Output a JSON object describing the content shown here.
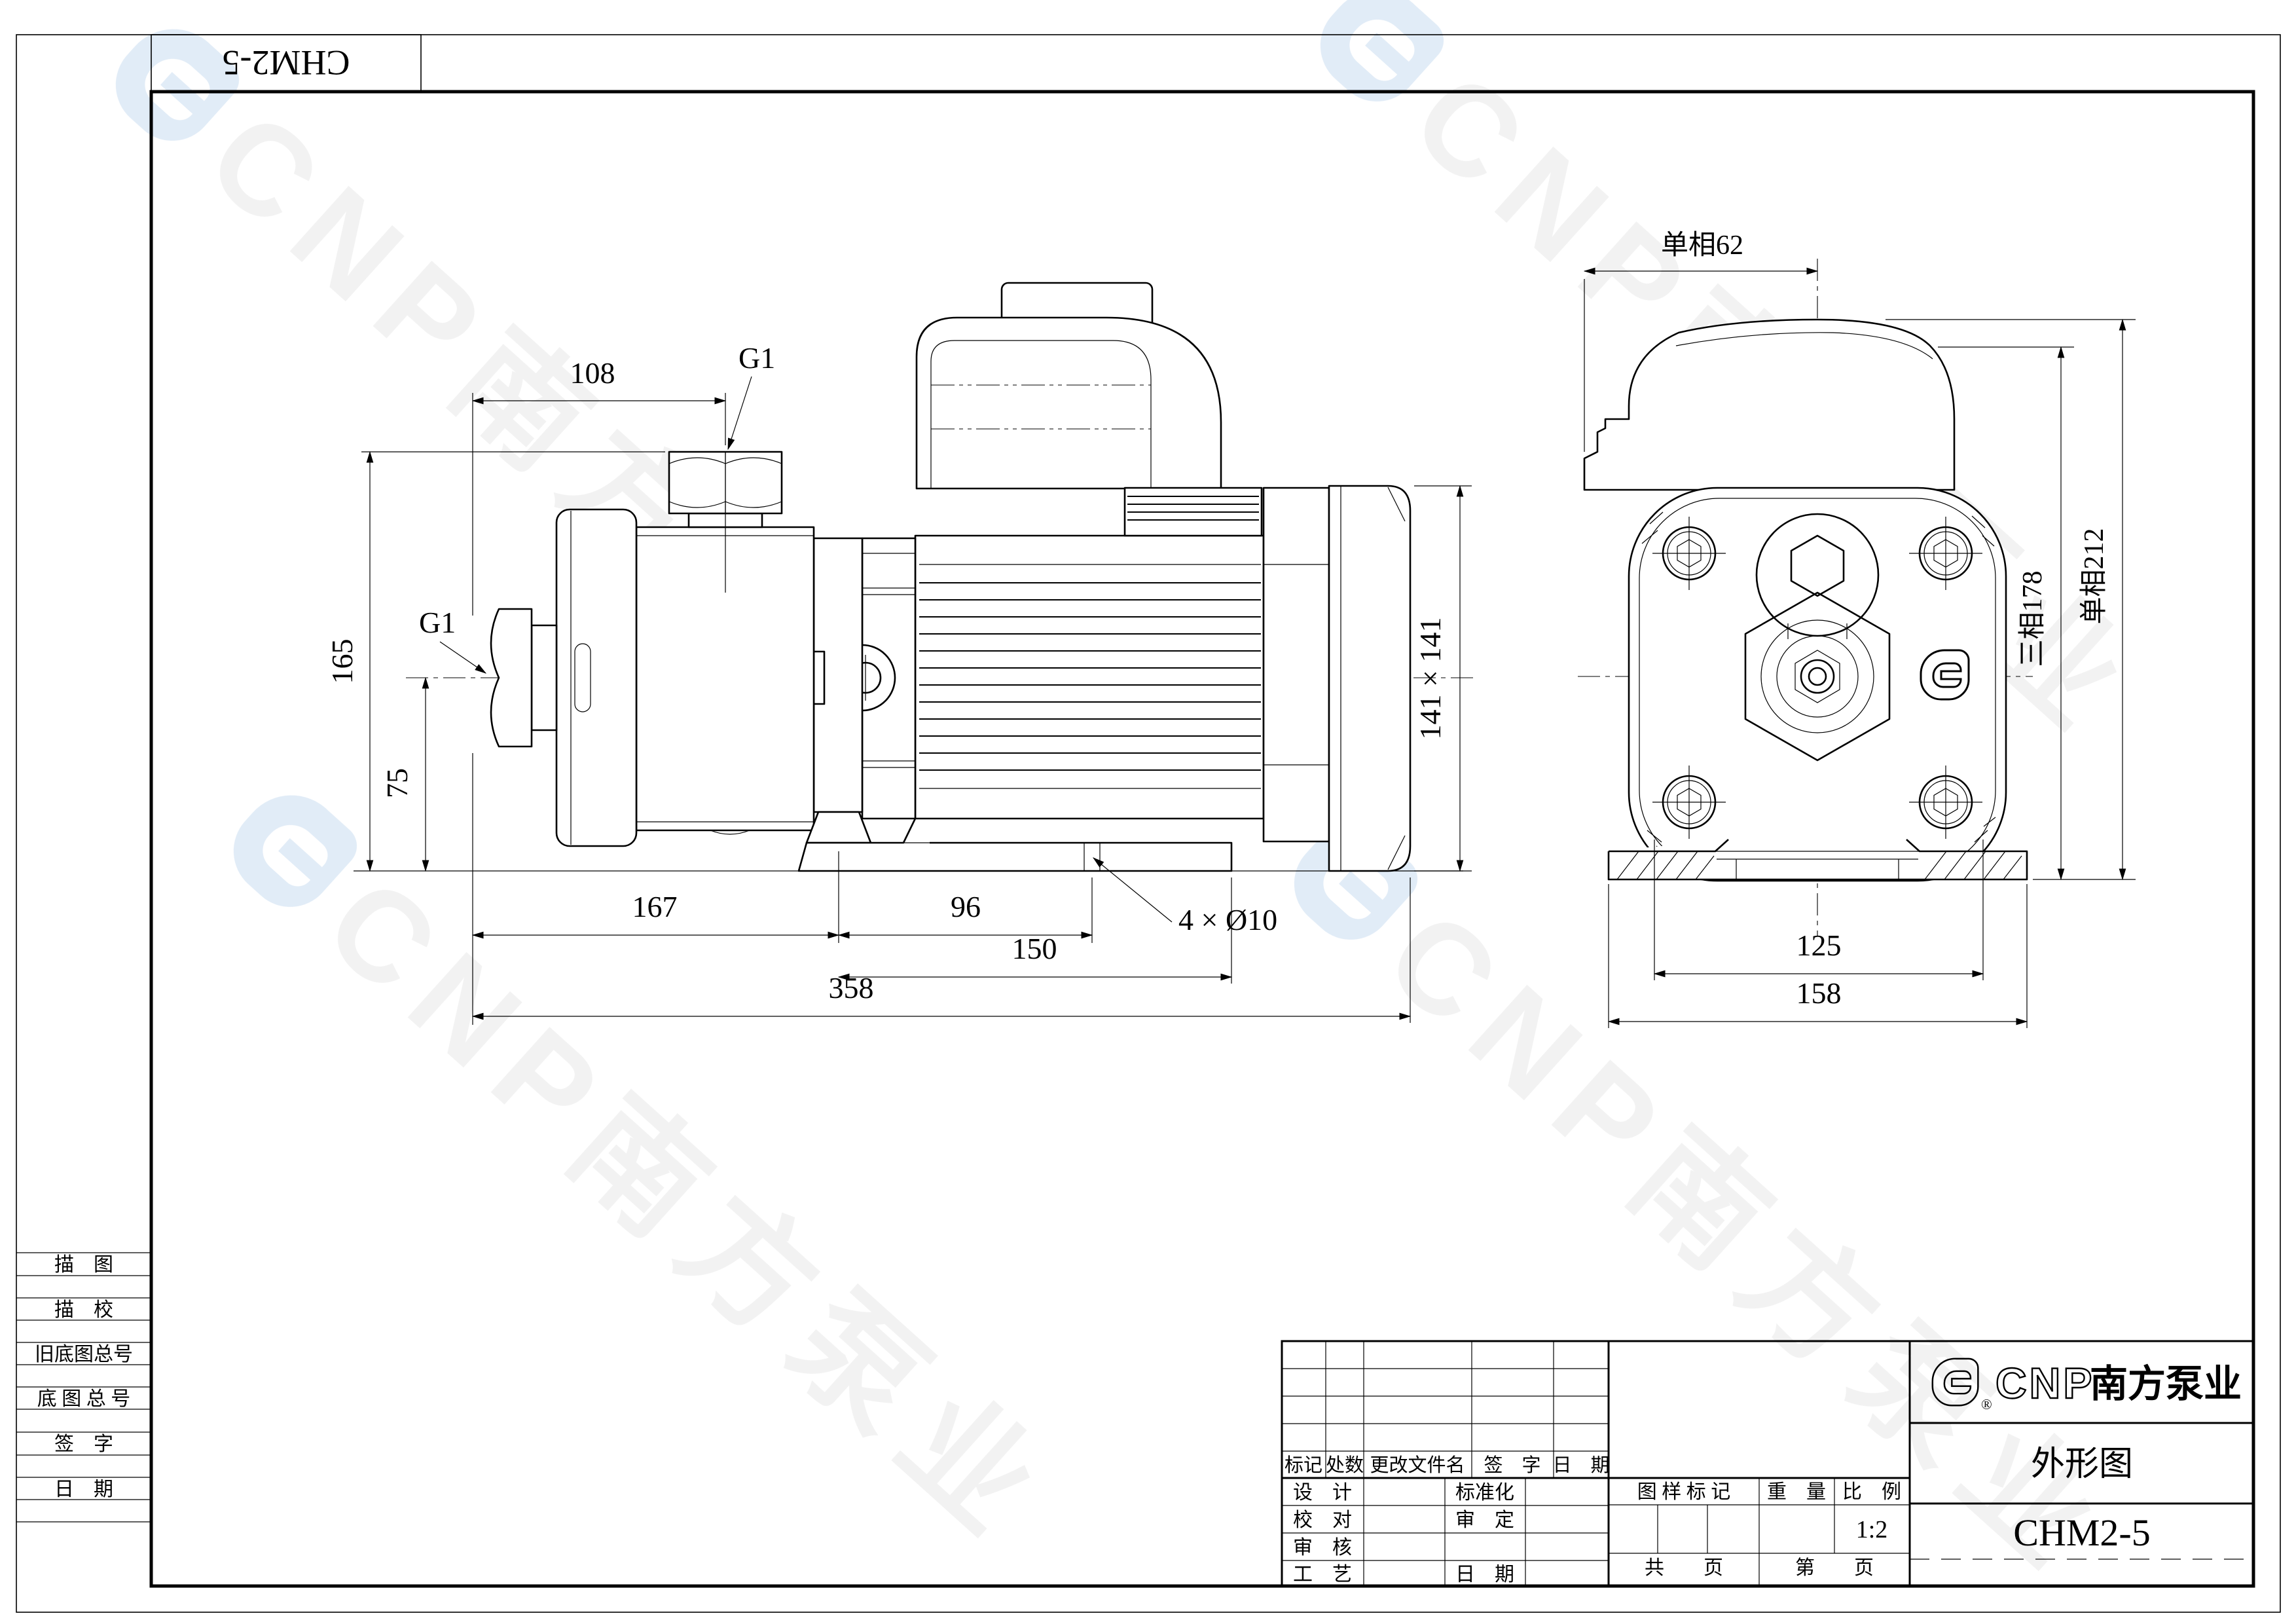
{
  "watermark": {
    "en": "CNP",
    "cn": "南方泵业"
  },
  "corner": {
    "code": "CHM2-5"
  },
  "sidebar": {
    "r1": "描　图",
    "r2": "描　校",
    "r3": "旧底图总号",
    "r4": "底 图 总 号",
    "r5": "签　字",
    "r6": "日　期"
  },
  "dims": {
    "d108": "108",
    "g1_discharge": "G1",
    "g1_suction": "G1",
    "d165": "165",
    "d75": "75",
    "d167": "167",
    "d96": "96",
    "d150": "150",
    "d358": "358",
    "holes": "4 × Ø10",
    "frame": "141 × 141",
    "top_single": "单相62",
    "right_three": "三相178",
    "right_single": "单相212",
    "d125": "125",
    "d158": "158"
  },
  "title_block": {
    "rev": {
      "c1": "标记",
      "c2": "处数",
      "c3": "更改文件名",
      "c4": "签　字",
      "c5": "日　期"
    },
    "sig": {
      "design": "设　计",
      "standard": "标准化",
      "check": "校　对",
      "approve": "审　定",
      "audit": "审　核",
      "craft": "工　艺",
      "date": "日　期"
    },
    "mark": {
      "sample": "图 样 标 记",
      "weight": "重　量",
      "scale": "比　例",
      "scale_val": "1:2",
      "pages_total": "共　　页",
      "page_no": "第　　页"
    },
    "brand": {
      "en": "CNP",
      "cn": "南方泵业",
      "reg": "®"
    },
    "doc": {
      "type": "外形图",
      "model": "CHM2-5"
    }
  }
}
